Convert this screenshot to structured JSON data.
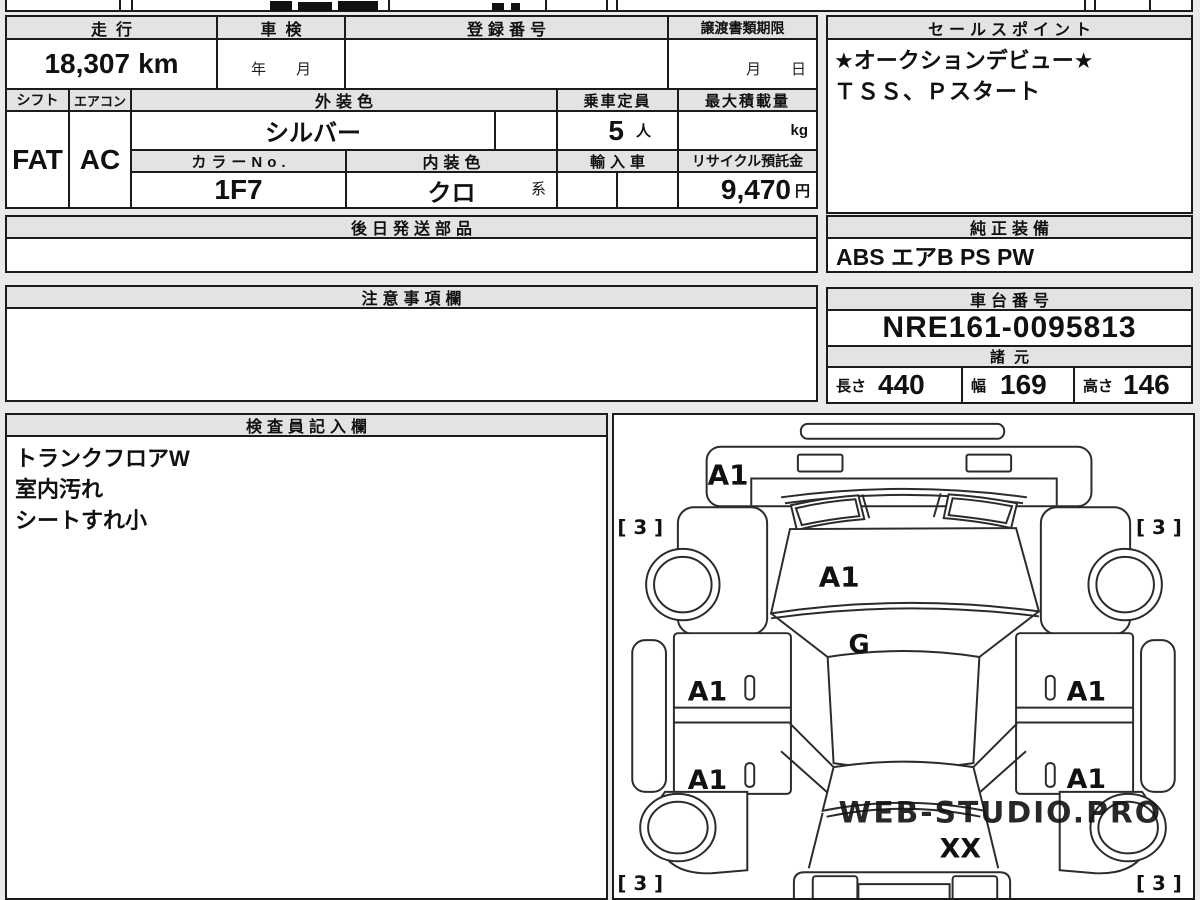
{
  "colors": {
    "page_bg": "#eaeaea",
    "line_color": "#1b1b1b",
    "header_bg": "#e3e3e3",
    "watermark_color": "#cdd2d7"
  },
  "left_table": {
    "mileage_header": "走行",
    "mileage_value": "18,307",
    "mileage_unit": "km",
    "shaken_header": "車検",
    "shaken_placeholder": "年　　月",
    "registration_header": "登録番号",
    "transfer_header": "譲渡書類期限",
    "transfer_placeholder": "月　　日",
    "shift_header": "シフト",
    "shift_value": "FAT",
    "aircon_header": "エアコン",
    "aircon_value": "AC",
    "exterior_header": "外装色",
    "exterior_value": "シルバー",
    "capacity_header": "乗車定員",
    "capacity_value": "5",
    "capacity_unit": "人",
    "maxload_header": "最大積載量",
    "maxload_unit": "kg",
    "colorno_header": "カラーNo.",
    "colorno_value": "1F7",
    "interior_header": "内装色",
    "interior_value": "クロ",
    "interior_suffix": "系",
    "import_header": "輸入車",
    "recycle_header": "リサイクル預託金",
    "recycle_value": "9,470",
    "recycle_unit": "円",
    "later_parts_header": "後日発送部品",
    "notes_header": "注意事項欄",
    "inspector_header": "検査員記入欄",
    "inspector_notes": [
      "トランクフロアW",
      "室内汚れ",
      "シートすれ小"
    ]
  },
  "right_panel": {
    "sales_header": "セールスポイント",
    "sales_lines": [
      "★オークションデビュー★",
      "ＴＳＳ、Ｐスタート"
    ],
    "equipment_header": "純正装備",
    "equipment_value": "ABS エアB PS PW",
    "chassis_header": "車台番号",
    "chassis_value": "NRE161-0095813",
    "specs_header": "諸元",
    "length_label": "長さ",
    "length_value": "440",
    "width_label": "幅",
    "width_value": "169",
    "height_label": "高さ",
    "height_value": "146"
  },
  "diagram": {
    "hood_label": "A1",
    "windshield_label": "A1",
    "roof_label": "G",
    "door_front_left": "A1",
    "door_rear_left": "A1",
    "door_front_right": "A1",
    "door_rear_right": "A1",
    "trunk_label": "XX",
    "tire_front_left": "[ 3 ]",
    "tire_front_right": "[ 3 ]",
    "tire_rear_left": "[ 3 ]",
    "tire_rear_right": "[ 3 ]",
    "watermark": "WEB-STUDIO.PRO"
  }
}
